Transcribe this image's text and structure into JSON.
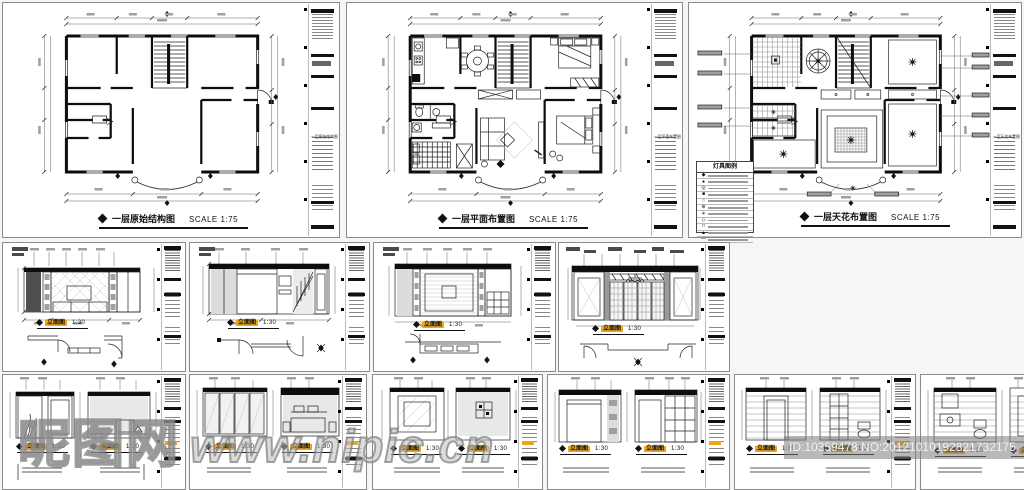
{
  "watermark": {
    "site_name": "昵图网",
    "site_url": "www.nipic.cn"
  },
  "id_bar": {
    "text": "ID:10359478 NO:20121010192821732175"
  },
  "titleblock": {
    "project_label": "PROJECT"
  },
  "plans": {
    "structure": {
      "title": "一层原始结构图",
      "scale": "SCALE 1:75"
    },
    "furniture": {
      "title": "一层平面布置图",
      "scale": "SCALE 1:75"
    },
    "ceiling": {
      "title": "一层天花布置图",
      "scale": "SCALE 1:75"
    }
  },
  "legend": {
    "title": "灯具图例",
    "symbols": [
      "◆",
      "●",
      "◎",
      "■",
      "○",
      "⊕",
      "✳",
      "◇",
      "□",
      "▲",
      "—"
    ]
  },
  "elevation": {
    "title": "立面图",
    "scale": "1:30"
  },
  "colors": {
    "highlight": "#eca61d",
    "dark_band": "#0d0d0d",
    "wall_gray": "#e3e3e3"
  }
}
